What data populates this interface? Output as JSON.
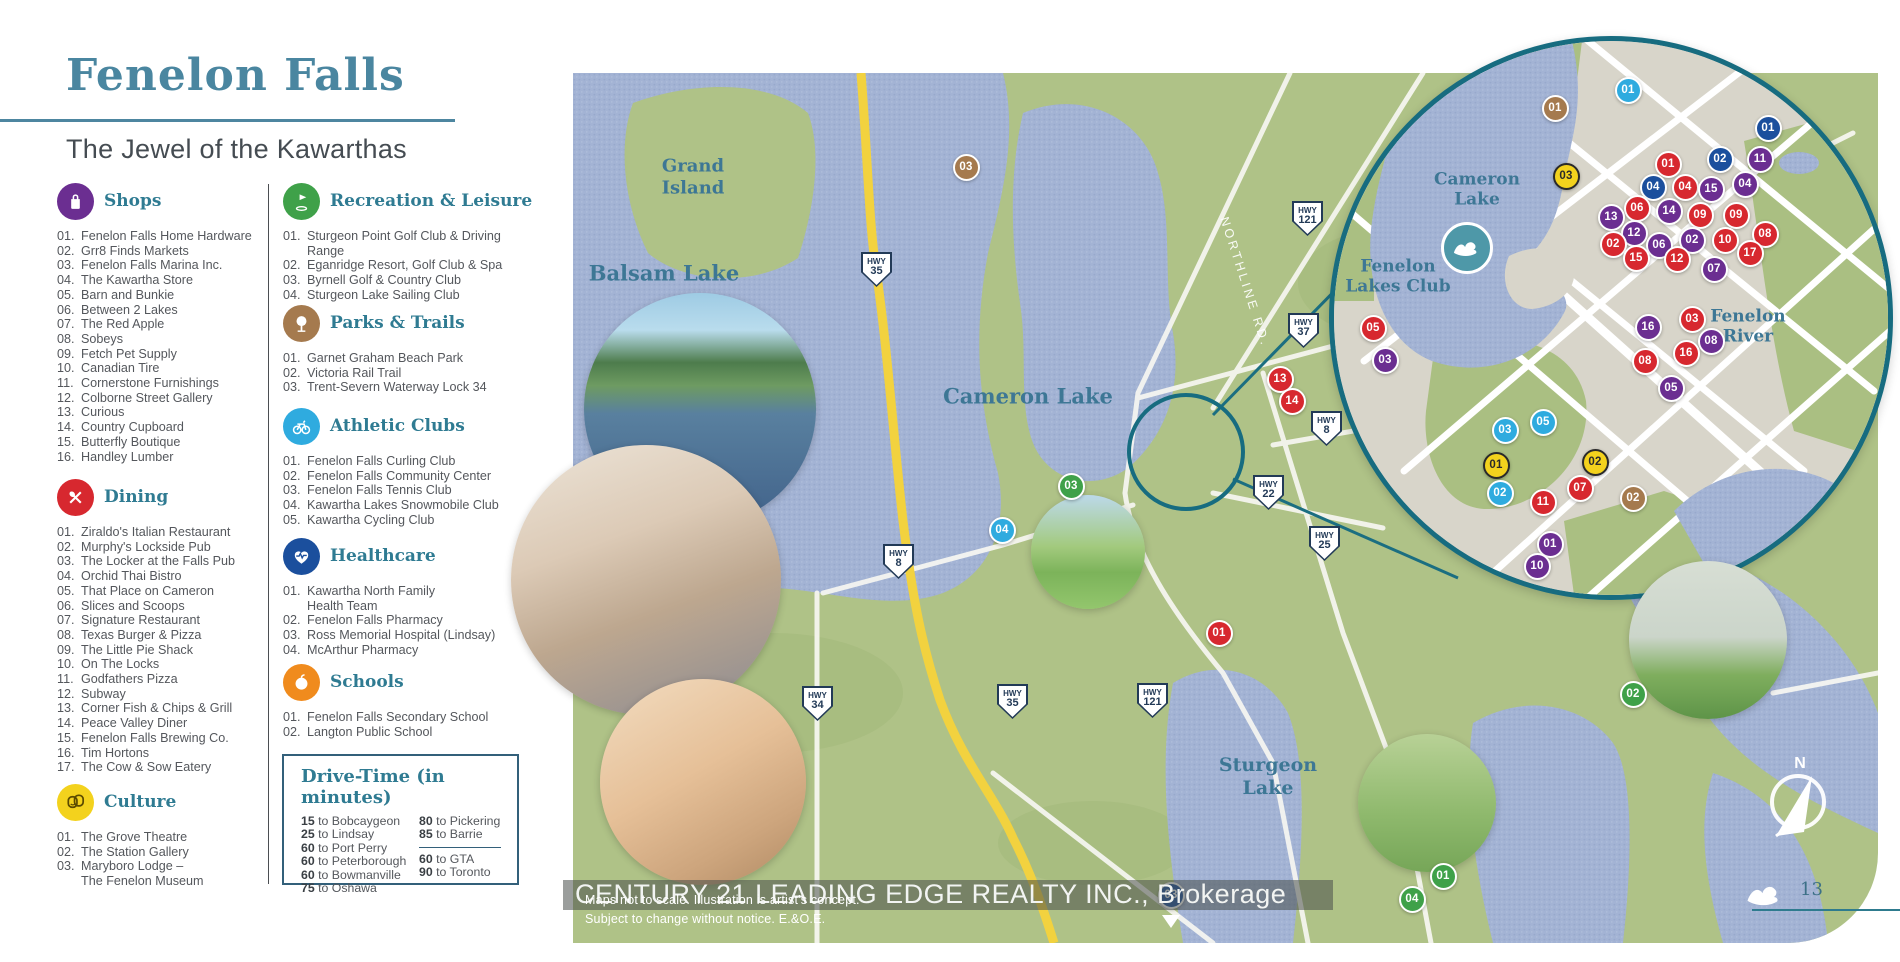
{
  "page": {
    "title": "Fenelon Falls",
    "subtitle": "The Jewel of the Kawarthas",
    "page_number": "13",
    "brokerage": "CENTURY 21 LEADING EDGE REALTY INC., Brokerage",
    "disclaimer_line1": "Maps not to scale. Illustration is artist's concept.",
    "disclaimer_line2": "Subject to change without notice. E.&O.E.",
    "compass_label": "N"
  },
  "colors": {
    "accent_teal": "#4d86a0",
    "heading_teal": "#2f7b92",
    "map_label_teal": "#3d7795",
    "inset_border_teal": "#176c80",
    "land_green": "#afc287",
    "water_blue": "#a3b3d4",
    "urban_gray": "#d8d5ca",
    "highway_yellow": "#f2d23f",
    "shops": "#6b2e91",
    "dining": "#d7282f",
    "culture": "#f3d21d",
    "recreation": "#3fa149",
    "parks": "#a57a4e",
    "athletic": "#2fabdf",
    "healthcare": "#1b4f9d",
    "schools": "#f08b1d"
  },
  "legend": {
    "sections": [
      {
        "id": "shops",
        "label": "Shops",
        "icon": "shopping-bag-icon",
        "items": [
          {
            "n": "01",
            "label": "Fenelon Falls Home Hardware"
          },
          {
            "n": "02",
            "label": "Grr8 Finds Markets"
          },
          {
            "n": "03",
            "label": "Fenelon Falls Marina Inc."
          },
          {
            "n": "04",
            "label": "The Kawartha Store"
          },
          {
            "n": "05",
            "label": "Barn and Bunkie"
          },
          {
            "n": "06",
            "label": "Between 2 Lakes"
          },
          {
            "n": "07",
            "label": "The Red Apple"
          },
          {
            "n": "08",
            "label": "Sobeys"
          },
          {
            "n": "09",
            "label": "Fetch Pet Supply"
          },
          {
            "n": "10",
            "label": "Canadian Tire"
          },
          {
            "n": "11",
            "label": "Cornerstone Furnishings"
          },
          {
            "n": "12",
            "label": "Colborne Street Gallery"
          },
          {
            "n": "13",
            "label": "Curious"
          },
          {
            "n": "14",
            "label": "Country Cupboard"
          },
          {
            "n": "15",
            "label": "Butterfly Boutique"
          },
          {
            "n": "16",
            "label": "Handley Lumber"
          }
        ]
      },
      {
        "id": "dining",
        "label": "Dining",
        "icon": "utensils-icon",
        "items": [
          {
            "n": "01",
            "label": "Ziraldo's Italian Restaurant"
          },
          {
            "n": "02",
            "label": "Murphy's Lockside Pub"
          },
          {
            "n": "03",
            "label": "The Locker at the Falls Pub"
          },
          {
            "n": "04",
            "label": "Orchid Thai Bistro"
          },
          {
            "n": "05",
            "label": "That Place on Cameron"
          },
          {
            "n": "06",
            "label": "Slices and Scoops"
          },
          {
            "n": "07",
            "label": "Signature Restaurant"
          },
          {
            "n": "08",
            "label": "Texas Burger & Pizza"
          },
          {
            "n": "09",
            "label": "The Little Pie Shack"
          },
          {
            "n": "10",
            "label": "On The Locks"
          },
          {
            "n": "11",
            "label": "Godfathers Pizza"
          },
          {
            "n": "12",
            "label": "Subway"
          },
          {
            "n": "13",
            "label": "Corner Fish & Chips & Grill"
          },
          {
            "n": "14",
            "label": "Peace Valley Diner"
          },
          {
            "n": "15",
            "label": "Fenelon Falls Brewing Co."
          },
          {
            "n": "16",
            "label": "Tim Hortons"
          },
          {
            "n": "17",
            "label": "The Cow & Sow Eatery"
          }
        ]
      },
      {
        "id": "culture",
        "label": "Culture",
        "icon": "theater-masks-icon",
        "items": [
          {
            "n": "01",
            "label": "The Grove Theatre"
          },
          {
            "n": "02",
            "label": "The Station Gallery"
          },
          {
            "n": "03",
            "label": "Maryboro Lodge –\nThe Fenelon Museum"
          }
        ]
      },
      {
        "id": "recreation",
        "label": "Recreation & Leisure",
        "icon": "golf-icon",
        "items": [
          {
            "n": "01",
            "label": "Sturgeon Point Golf Club & Driving Range"
          },
          {
            "n": "02",
            "label": "Eganridge Resort, Golf Club & Spa"
          },
          {
            "n": "03",
            "label": "Byrnell Golf & Country Club"
          },
          {
            "n": "04",
            "label": "Sturgeon Lake Sailing Club"
          }
        ]
      },
      {
        "id": "parks",
        "label": "Parks & Trails",
        "icon": "tree-icon",
        "items": [
          {
            "n": "01",
            "label": "Garnet Graham Beach Park"
          },
          {
            "n": "02",
            "label": "Victoria Rail Trail"
          },
          {
            "n": "03",
            "label": "Trent-Severn Waterway Lock 34"
          }
        ]
      },
      {
        "id": "athletic",
        "label": "Athletic Clubs",
        "icon": "bicycle-icon",
        "items": [
          {
            "n": "01",
            "label": "Fenelon Falls Curling Club"
          },
          {
            "n": "02",
            "label": "Fenelon Falls Community Center"
          },
          {
            "n": "03",
            "label": "Fenelon Falls Tennis Club"
          },
          {
            "n": "04",
            "label": "Kawartha Lakes Snowmobile Club"
          },
          {
            "n": "05",
            "label": "Kawartha Cycling Club"
          }
        ]
      },
      {
        "id": "healthcare",
        "label": "Healthcare",
        "icon": "heart-pulse-icon",
        "items": [
          {
            "n": "01",
            "label": "Kawartha North Family\nHealth Team"
          },
          {
            "n": "02",
            "label": "Fenelon Falls Pharmacy"
          },
          {
            "n": "03",
            "label": "Ross Memorial Hospital (Lindsay)"
          },
          {
            "n": "04",
            "label": "McArthur Pharmacy"
          }
        ]
      },
      {
        "id": "schools",
        "label": "Schools",
        "icon": "apple-icon",
        "items": [
          {
            "n": "01",
            "label": "Fenelon Falls Secondary School"
          },
          {
            "n": "02",
            "label": "Langton Public School"
          }
        ]
      }
    ]
  },
  "drive_time": {
    "title": "Drive-Time (in minutes)",
    "left": [
      {
        "mins": "15",
        "dest": "Bobcaygeon"
      },
      {
        "mins": "25",
        "dest": "Lindsay"
      },
      {
        "mins": "60",
        "dest": "Port Perry"
      },
      {
        "mins": "60",
        "dest": "Peterborough"
      },
      {
        "mins": "60",
        "dest": "Bowmanville"
      },
      {
        "mins": "75",
        "dest": "Oshawa"
      }
    ],
    "right_top": [
      {
        "mins": "80",
        "dest": "Pickering"
      },
      {
        "mins": "85",
        "dest": "Barrie"
      }
    ],
    "right_bottom": [
      {
        "mins": "60",
        "dest": "GTA"
      },
      {
        "mins": "90",
        "dest": "Toronto"
      }
    ]
  },
  "map": {
    "northline_label": "NORTHLINE RD.",
    "labels": [
      {
        "text": "Grand\nIsland",
        "x": 693,
        "y": 177,
        "size": 18
      },
      {
        "text": "Balsam Lake",
        "x": 664,
        "y": 273,
        "size": 21
      },
      {
        "text": "Cameron Lake",
        "x": 1028,
        "y": 396,
        "size": 21
      },
      {
        "text": "Sturgeon\nLake",
        "x": 1268,
        "y": 777,
        "size": 19
      },
      {
        "text": "Cameron\nLake",
        "x": 1477,
        "y": 190,
        "size": 17
      },
      {
        "text": "Fenelon\nLakes Club",
        "x": 1398,
        "y": 277,
        "size": 17
      },
      {
        "text": "Fenelon\nRiver",
        "x": 1748,
        "y": 327,
        "size": 17
      }
    ],
    "highways": [
      {
        "label": "HWY",
        "num": "35",
        "x": 876,
        "y": 269
      },
      {
        "label": "HWY",
        "num": "121",
        "x": 1307,
        "y": 218
      },
      {
        "label": "HWY",
        "num": "37",
        "x": 1303,
        "y": 330
      },
      {
        "label": "HWY",
        "num": "8",
        "x": 1326,
        "y": 428
      },
      {
        "label": "HWY",
        "num": "22",
        "x": 1268,
        "y": 492
      },
      {
        "label": "HWY",
        "num": "25",
        "x": 1324,
        "y": 543
      },
      {
        "label": "HWY",
        "num": "8",
        "x": 898,
        "y": 561
      },
      {
        "label": "HWY",
        "num": "34",
        "x": 817,
        "y": 703
      },
      {
        "label": "HWY",
        "num": "35",
        "x": 1012,
        "y": 701
      },
      {
        "label": "HWY",
        "num": "121",
        "x": 1152,
        "y": 700
      }
    ],
    "markers": [
      {
        "n": "03",
        "cat": "parks",
        "x": 966,
        "y": 167
      },
      {
        "n": "13",
        "cat": "dining",
        "x": 1280,
        "y": 379
      },
      {
        "n": "14",
        "cat": "dining",
        "x": 1292,
        "y": 401
      },
      {
        "n": "03",
        "cat": "recreation",
        "x": 1071,
        "y": 486
      },
      {
        "n": "04",
        "cat": "athletic",
        "x": 1002,
        "y": 530
      },
      {
        "n": "01",
        "cat": "dining",
        "x": 1219,
        "y": 633
      },
      {
        "n": "02",
        "cat": "recreation",
        "x": 1633,
        "y": 694
      },
      {
        "n": "01",
        "cat": "recreation",
        "x": 1443,
        "y": 876
      },
      {
        "n": "04",
        "cat": "recreation",
        "x": 1412,
        "y": 899
      },
      {
        "n": "03",
        "cat": "healthcare",
        "x": 1171,
        "y": 895
      },
      {
        "n": "01",
        "cat": "parks",
        "x": 1555,
        "y": 108
      },
      {
        "n": "01",
        "cat": "athletic",
        "x": 1628,
        "y": 90
      },
      {
        "n": "01",
        "cat": "healthcare",
        "x": 1768,
        "y": 128
      },
      {
        "n": "01",
        "cat": "dining",
        "x": 1668,
        "y": 164
      },
      {
        "n": "02",
        "cat": "healthcare",
        "x": 1720,
        "y": 159
      },
      {
        "n": "11",
        "cat": "shops",
        "x": 1760,
        "y": 159
      },
      {
        "n": "03",
        "cat": "culture",
        "x": 1566,
        "y": 176
      },
      {
        "n": "04",
        "cat": "healthcare",
        "x": 1653,
        "y": 187
      },
      {
        "n": "04",
        "cat": "dining",
        "x": 1685,
        "y": 187
      },
      {
        "n": "15",
        "cat": "shops",
        "x": 1711,
        "y": 189
      },
      {
        "n": "04",
        "cat": "shops",
        "x": 1745,
        "y": 184
      },
      {
        "n": "06",
        "cat": "dining",
        "x": 1637,
        "y": 208
      },
      {
        "n": "13",
        "cat": "shops",
        "x": 1611,
        "y": 217
      },
      {
        "n": "14",
        "cat": "shops",
        "x": 1669,
        "y": 211
      },
      {
        "n": "09",
        "cat": "dining",
        "x": 1700,
        "y": 215
      },
      {
        "n": "09",
        "cat": "dining",
        "x": 1736,
        "y": 215
      },
      {
        "n": "12",
        "cat": "shops",
        "x": 1634,
        "y": 233
      },
      {
        "n": "02",
        "cat": "dining",
        "x": 1613,
        "y": 244
      },
      {
        "n": "06",
        "cat": "shops",
        "x": 1659,
        "y": 245
      },
      {
        "n": "02",
        "cat": "shops",
        "x": 1692,
        "y": 240
      },
      {
        "n": "10",
        "cat": "dining",
        "x": 1725,
        "y": 240
      },
      {
        "n": "08",
        "cat": "dining",
        "x": 1765,
        "y": 234
      },
      {
        "n": "15",
        "cat": "dining",
        "x": 1636,
        "y": 258
      },
      {
        "n": "12",
        "cat": "dining",
        "x": 1677,
        "y": 259
      },
      {
        "n": "17",
        "cat": "dining",
        "x": 1750,
        "y": 253
      },
      {
        "n": "07",
        "cat": "shops",
        "x": 1714,
        "y": 269
      },
      {
        "n": "16",
        "cat": "shops",
        "x": 1648,
        "y": 327
      },
      {
        "n": "03",
        "cat": "dining",
        "x": 1692,
        "y": 319
      },
      {
        "n": "08",
        "cat": "shops",
        "x": 1711,
        "y": 341
      },
      {
        "n": "16",
        "cat": "dining",
        "x": 1686,
        "y": 353
      },
      {
        "n": "08",
        "cat": "dining",
        "x": 1645,
        "y": 361
      },
      {
        "n": "05",
        "cat": "shops",
        "x": 1671,
        "y": 388
      },
      {
        "n": "05",
        "cat": "dining",
        "x": 1373,
        "y": 328
      },
      {
        "n": "03",
        "cat": "shops",
        "x": 1385,
        "y": 360
      },
      {
        "n": "05",
        "cat": "athletic",
        "x": 1543,
        "y": 422
      },
      {
        "n": "03",
        "cat": "athletic",
        "x": 1505,
        "y": 430
      },
      {
        "n": "01",
        "cat": "culture",
        "x": 1496,
        "y": 465
      },
      {
        "n": "02",
        "cat": "culture",
        "x": 1595,
        "y": 462
      },
      {
        "n": "07",
        "cat": "dining",
        "x": 1580,
        "y": 488
      },
      {
        "n": "02",
        "cat": "athletic",
        "x": 1500,
        "y": 493
      },
      {
        "n": "11",
        "cat": "dining",
        "x": 1543,
        "y": 502
      },
      {
        "n": "02",
        "cat": "parks",
        "x": 1633,
        "y": 498
      },
      {
        "n": "01",
        "cat": "shops",
        "x": 1550,
        "y": 544
      },
      {
        "n": "10",
        "cat": "shops",
        "x": 1537,
        "y": 566
      }
    ],
    "photos": [
      {
        "name": "photo-locks-boats",
        "x": 700,
        "y": 409,
        "r": 116
      },
      {
        "name": "photo-senior-couple",
        "x": 646,
        "y": 580,
        "r": 135
      },
      {
        "name": "photo-window-shopping",
        "x": 703,
        "y": 782,
        "r": 103
      },
      {
        "name": "photo-golf-course",
        "x": 1088,
        "y": 552,
        "r": 57
      },
      {
        "name": "photo-golf-swing",
        "x": 1708,
        "y": 640,
        "r": 79
      },
      {
        "name": "photo-golf-couple",
        "x": 1427,
        "y": 803,
        "r": 69
      }
    ]
  }
}
